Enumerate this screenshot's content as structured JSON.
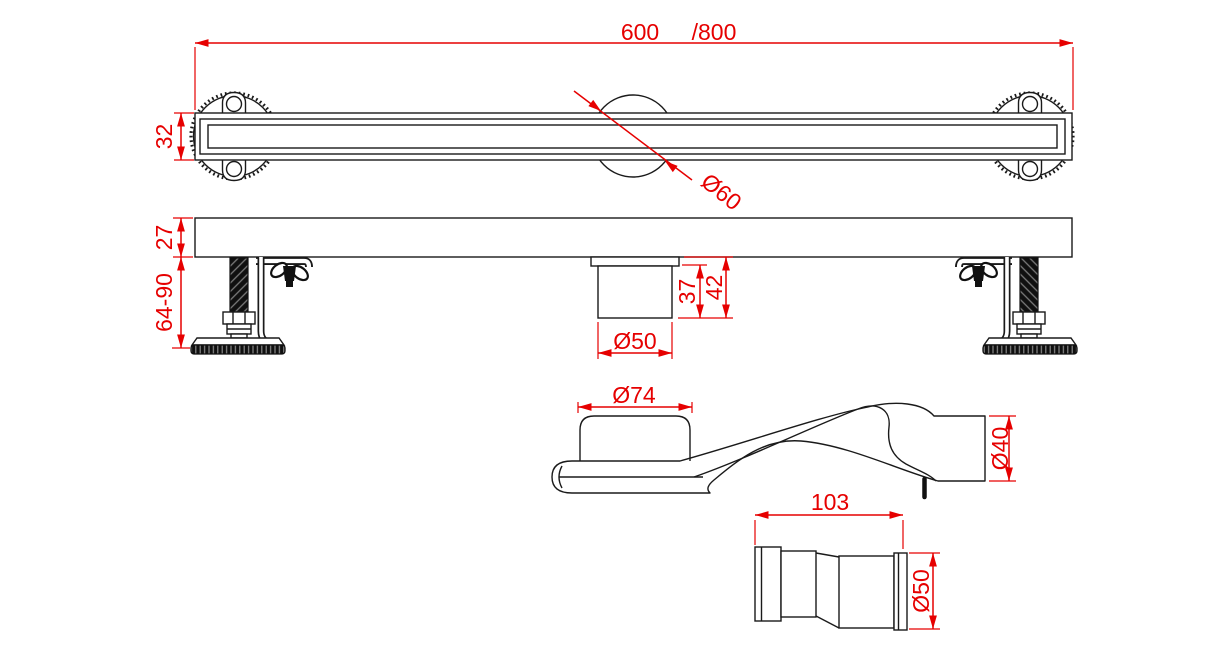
{
  "drawing": {
    "kind": "technical-drawing",
    "product": "linear shower drain channel with adjustable feet, siphon trap and pipe connector",
    "colors": {
      "dimension": "#e60000",
      "outline": "#1a1a1a",
      "background": "#ffffff"
    },
    "top_view": {
      "length_dim": "600",
      "length_alt_dim": "/800",
      "height_dim": "32",
      "drain_hole_dim": "Ø60"
    },
    "side_view": {
      "body_height_dim": "27",
      "foot_height_dim": "64-90",
      "outlet_height_dim": "37",
      "outlet_total_height_dim": "42",
      "outlet_diameter_dim": "Ø50"
    },
    "trap_view": {
      "inlet_diameter_dim": "Ø74",
      "outlet_diameter_dim": "Ø40"
    },
    "connector_view": {
      "length_dim": "103",
      "diameter_dim": "Ø50"
    }
  }
}
